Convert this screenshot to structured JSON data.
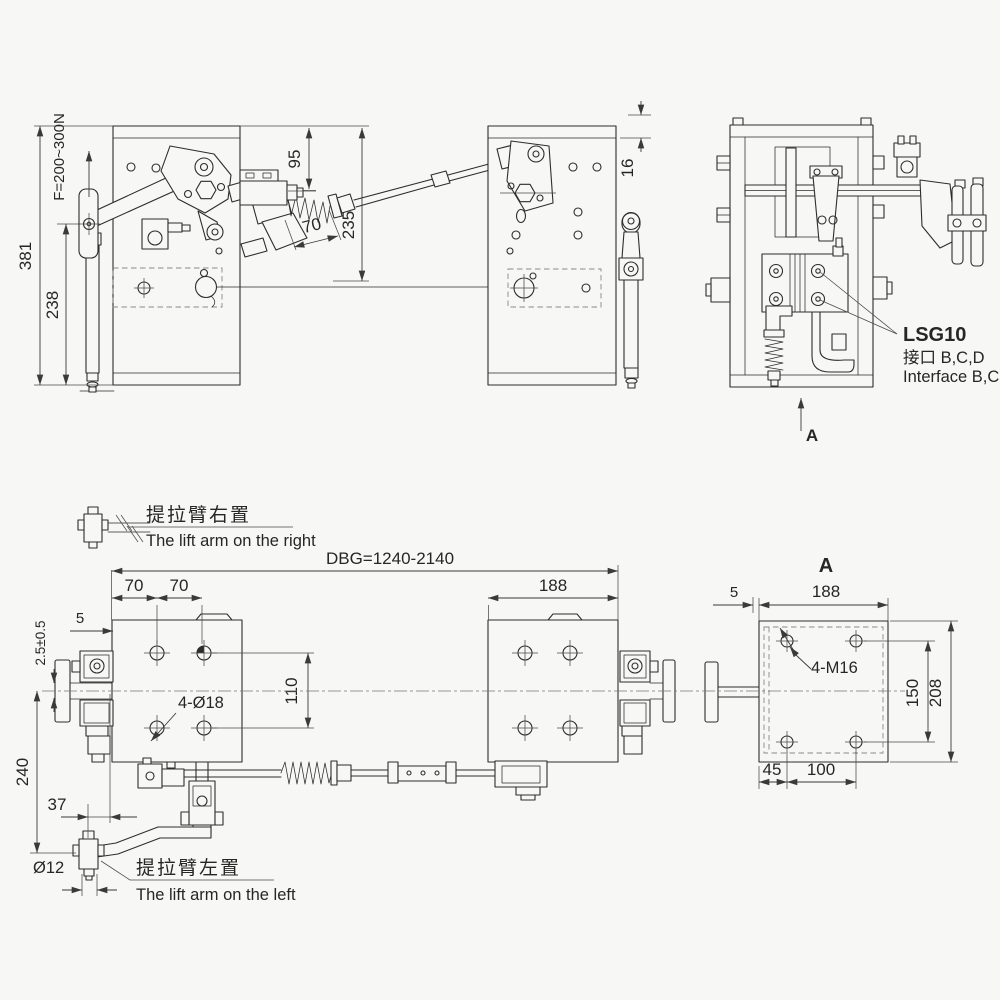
{
  "colors": {
    "background": "#f7f7f5",
    "line": "#2d2d2d",
    "dimension": "#3a3a3a",
    "centerline": "#777777",
    "dashed": "#888888"
  },
  "front_view": {
    "dim_total_height": "381",
    "dim_lower_height": "238",
    "force_label": "F=200~300N",
    "dim_top_offset": "95",
    "dim_spring_travel": "70",
    "dim_lever_height": "235"
  },
  "middle_view": {
    "dim_plate_offset": "16"
  },
  "side_view": {
    "callout_model": "LSG10",
    "callout_interface_cn": "接口 B,C,D",
    "callout_interface_en": "Interface B,C,D",
    "view_arrow_label": "A"
  },
  "plan_view": {
    "label_arm_right_cn": "提拉臂右置",
    "label_arm_right_en": "The lift arm  on the right",
    "label_arm_left_cn": "提拉臂左置",
    "label_arm_left_en": "The lift arm  on the left",
    "dim_rail_gauge": "DBG=1240-2140",
    "dim_hole_pitch_a": "70",
    "dim_hole_pitch_b": "70",
    "dim_block_width": "188",
    "dim_edge_gap": "5",
    "dim_running_clearance": "2.5±0.5",
    "dim_hole_pitch_v": "110",
    "callout_holes": "4-Ø18",
    "dim_arm_drop": "240",
    "dim_arm_offset": "37",
    "dim_pin_dia": "Ø12"
  },
  "detail_view": {
    "title": "A",
    "dim_edge_gap": "5",
    "dim_width": "188",
    "callout_threads": "4-M16",
    "dim_hole_pitch_v": "150",
    "dim_height": "208",
    "dim_hole_offset_x": "45",
    "dim_hole_pitch_x": "100"
  }
}
